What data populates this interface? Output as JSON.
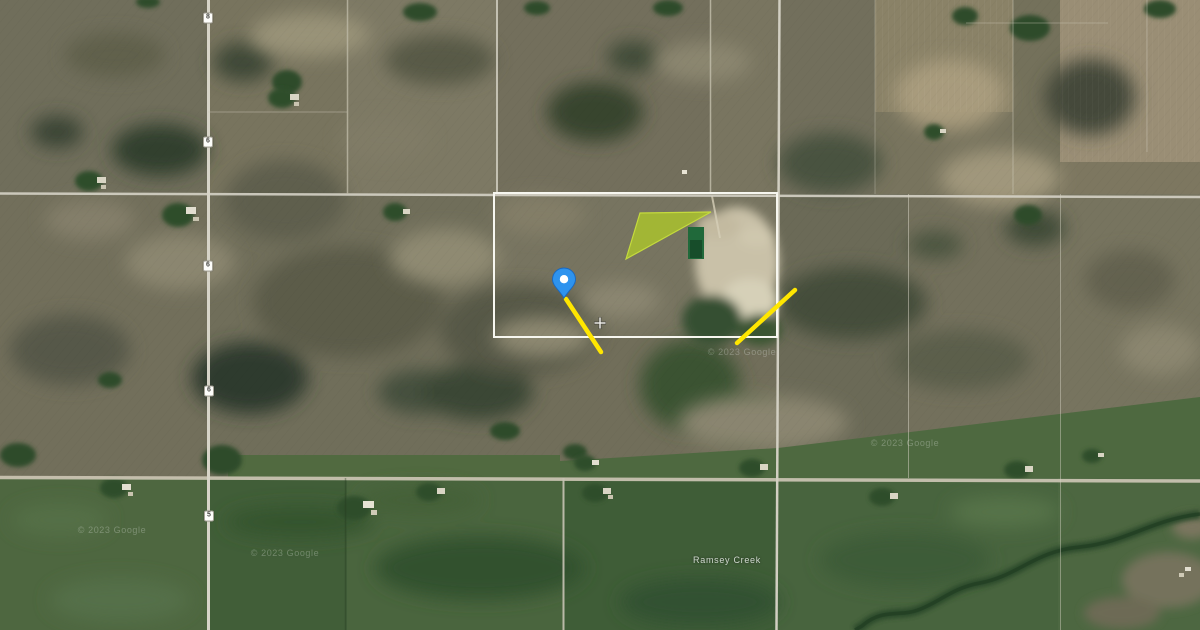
{
  "map": {
    "view_type": "satellite",
    "creek_label": {
      "text": "Ramsey Creek",
      "x": 727,
      "y": 560
    },
    "route_shields": [
      {
        "label": "8",
        "x": 208,
        "y": 18
      },
      {
        "label": "6",
        "x": 208,
        "y": 142
      },
      {
        "label": "6",
        "x": 208,
        "y": 266
      },
      {
        "label": "6",
        "x": 209,
        "y": 391
      },
      {
        "label": "5",
        "x": 209,
        "y": 516
      }
    ],
    "watermarks": [
      {
        "text": "© 2023 Google",
        "x": 112,
        "y": 530
      },
      {
        "text": "© 2023 Google",
        "x": 285,
        "y": 553
      },
      {
        "text": "© 2023 Google",
        "x": 742,
        "y": 352
      },
      {
        "text": "© 2023 Google",
        "x": 905,
        "y": 443
      }
    ],
    "annotations": {
      "pin": {
        "x": 564,
        "y": 298,
        "color": "#2e93ee",
        "outline": "#1867c0",
        "center_color": "#ffffff"
      },
      "parcel_boundary": {
        "x": 494,
        "y": 193,
        "width": 283,
        "height": 144,
        "color": "#f7f7f0"
      },
      "triangle": {
        "points": "626,259 640,213 711,212",
        "fill": "#a8bf2f",
        "stroke": "#c4da3d",
        "opacity": 0.88
      },
      "lines": [
        {
          "x1": 566,
          "y1": 299,
          "x2": 601,
          "y2": 352,
          "color": "#ffe600",
          "width": 4.5
        },
        {
          "x1": 737,
          "y1": 343,
          "x2": 795,
          "y2": 290,
          "color": "#ffe600",
          "width": 4.5
        }
      ],
      "crosshair": {
        "x": 600,
        "y": 323,
        "color": "#f2f2ee"
      }
    }
  }
}
